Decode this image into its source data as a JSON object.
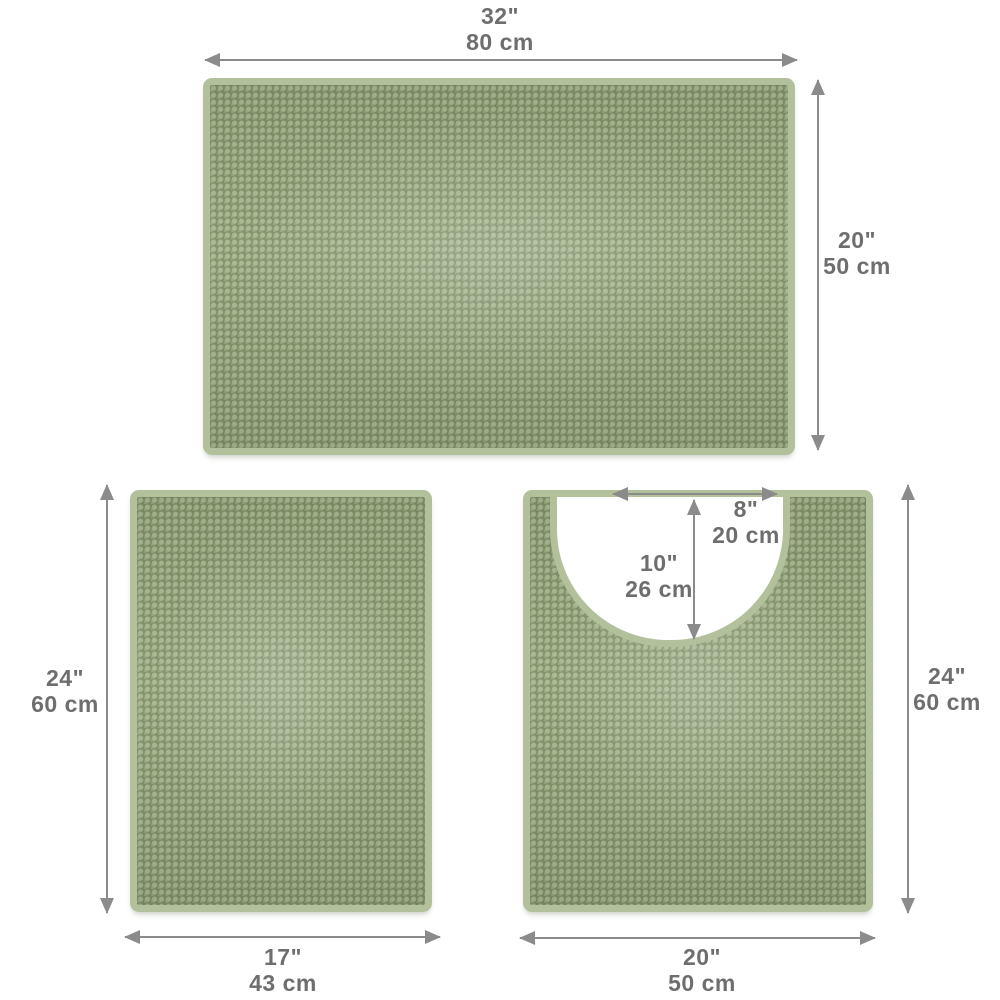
{
  "title": "3-piece chenille bath mat set dimension diagram",
  "colors": {
    "mat_border": "#b2c19c",
    "mat_pile": "#7e9066",
    "arrow": "#8b8b8b",
    "text": "#6e6e6e",
    "background": "#ffffff"
  },
  "mats": {
    "large": {
      "name": "large bath mat",
      "width": {
        "in": "32\"",
        "cm": "80 cm"
      },
      "height": {
        "in": "20\"",
        "cm": "50 cm"
      }
    },
    "small": {
      "name": "small bath mat",
      "height": {
        "in": "24\"",
        "cm": "60 cm"
      },
      "width": {
        "in": "17\"",
        "cm": "43 cm"
      }
    },
    "contour": {
      "name": "contour toilet mat",
      "cutout_width": {
        "in": "8\"",
        "cm": "20 cm"
      },
      "cutout_depth": {
        "in": "10\"",
        "cm": "26 cm"
      },
      "height": {
        "in": "24\"",
        "cm": "60 cm"
      },
      "width": {
        "in": "20\"",
        "cm": "50 cm"
      }
    }
  }
}
